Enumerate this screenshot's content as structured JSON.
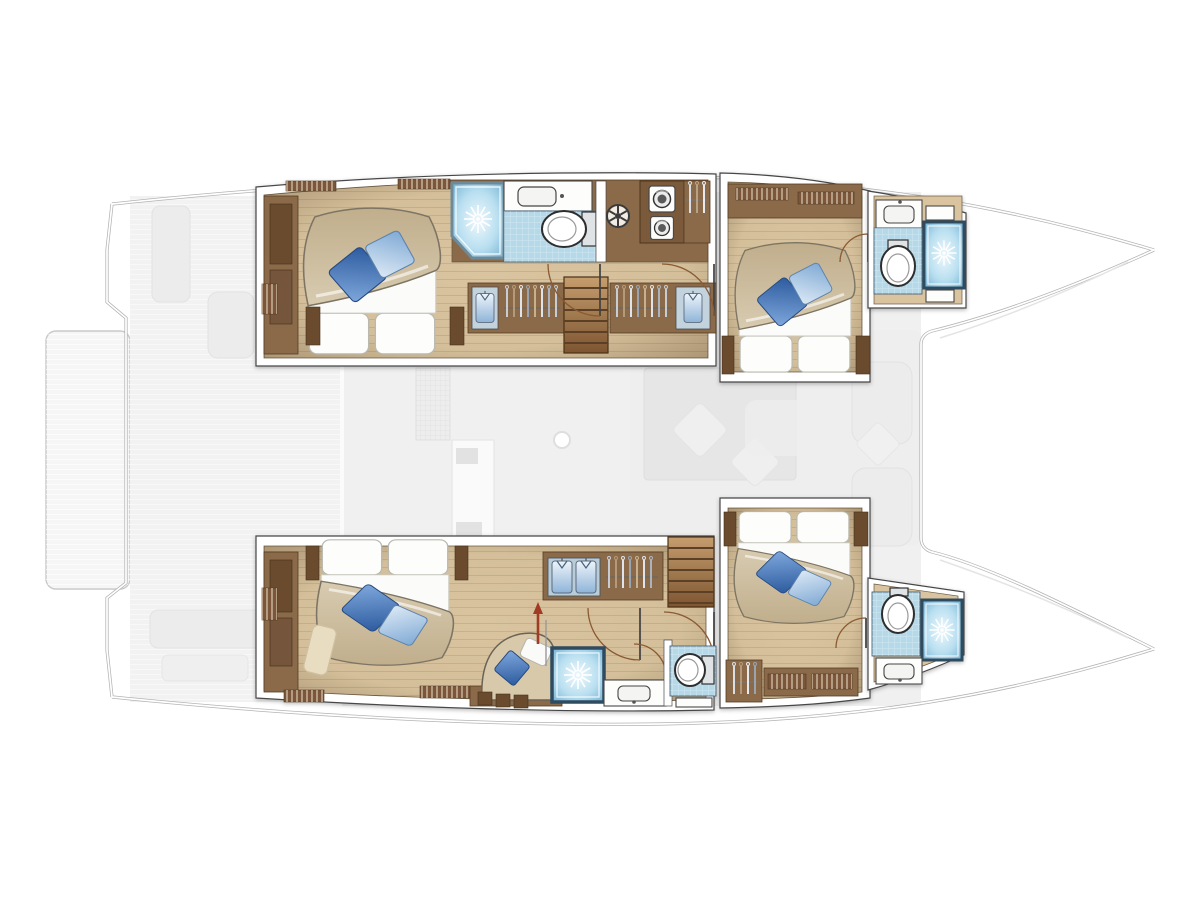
{
  "diagram": {
    "title": "Catamaran lower deck floor plan",
    "description": "Top-down layout plan of a sailing catamaran lower deck: four double guest cabins with blue accent pillows, four bathrooms with starburst shower cubicles, hanging lockers, companionway stairs in each hull, and a ghosted main-deck saloon, cockpit and swim platform shown between the hulls. Bow points right.",
    "orientation": {
      "bow": "right",
      "stern": "left",
      "port_hull": "top",
      "starboard_hull": "bottom"
    }
  },
  "colors": {
    "wall": "#ffffff",
    "wall_edge": "#474747",
    "hull_line": "#b3b3b3",
    "ghost_deck": "#f1f1f1",
    "ghost_deck_dark": "#ededed",
    "floor_wood": "#d9c49f",
    "cabinet_wood": "#8a6a49",
    "cabinet_dark": "#6a4c2f",
    "stairs_wood": "#b0885c",
    "bath_floor": "#b5d9e8",
    "shower_frame": "#2e4b5e",
    "shower_rim": "#6e8a99",
    "duvet": "#cec0a4",
    "pillow_dark_blue": "#3c6db0",
    "pillow_light_blue": "#a9c9e8",
    "linen_white": "#ffffff",
    "arrow_red": "#a23b28"
  },
  "port_hull": {
    "aft_cabin": {
      "name": "Port aft guest cabin",
      "furniture": [
        "double-bed",
        "wardrobe",
        "shelves",
        "bedside-lockers"
      ]
    },
    "aft_shower": {
      "name": "Port aft shower cubicle"
    },
    "aft_head": {
      "name": "Port aft head",
      "fixtures": [
        "washbasin",
        "toilet"
      ]
    },
    "companionway": {
      "name": "Port companionway",
      "features": [
        "stairs",
        "hanging-lockers",
        "washer-dryer-stack",
        "vent-hatch"
      ]
    },
    "forward_cabin": {
      "name": "Port forward guest cabin",
      "furniture": [
        "double-bed",
        "wardrobe",
        "shelves"
      ]
    },
    "forward_head": {
      "name": "Port forward bathroom",
      "fixtures": [
        "washbasin",
        "toilet",
        "shower"
      ]
    }
  },
  "starboard_hull": {
    "aft_cabin": {
      "name": "Starboard aft cabin",
      "furniture": [
        "double-bed",
        "wardrobe",
        "chaise-longue",
        "bookshelves",
        "rug"
      ]
    },
    "companionway": {
      "name": "Starboard companionway",
      "features": [
        "stairs",
        "hanging-lockers",
        "folded-linen-shelves",
        "direction-arrow"
      ]
    },
    "mid_shower": {
      "name": "Starboard mid shower cubicle"
    },
    "mid_head": {
      "name": "Starboard mid head",
      "fixtures": [
        "washbasin",
        "toilet"
      ]
    },
    "forward_cabin": {
      "name": "Starboard forward guest cabin",
      "furniture": [
        "double-bed",
        "hanging-locker",
        "bookshelves"
      ]
    },
    "forward_head": {
      "name": "Starboard forward bathroom",
      "fixtures": [
        "toilet",
        "shower",
        "washbasin"
      ]
    }
  },
  "ghost_deck": {
    "name": "Main deck (ghosted)",
    "features": [
      "swim-platform",
      "aft-cockpit",
      "saloon-table",
      "galley",
      "sofas",
      "mast",
      "foredeck"
    ]
  },
  "icons": [
    "shower-starburst-icon",
    "toilet-icon",
    "washbasin-icon",
    "hanger-icon",
    "shirt-icon",
    "washer-dryer-icon",
    "vent-hatch-icon",
    "stairs-icon",
    "door-swing-icon",
    "direction-arrow-icon"
  ]
}
